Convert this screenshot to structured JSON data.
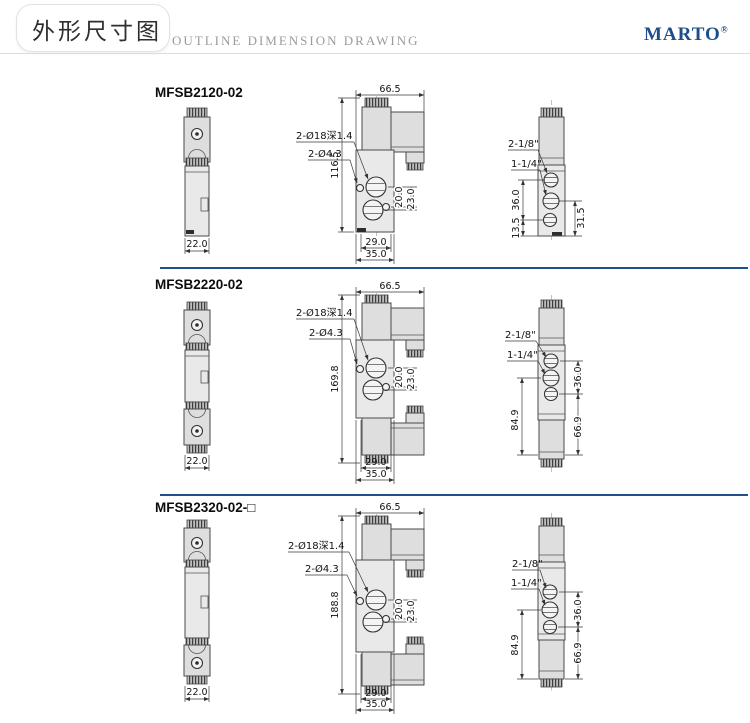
{
  "header": {
    "title_cn": "外形尺寸图",
    "title_en": "OUTLINE DIMENSION DRAWING",
    "brand": "MARTO",
    "brand_mark": "®"
  },
  "sections": [
    {
      "model": "MFSB2120-02",
      "front": {
        "width": "22.0"
      },
      "main": {
        "width": "66.5",
        "height": "116.5",
        "hole_label_1": "2-Ø18深1.4",
        "hole_label_2": "2-Ø4.3",
        "port_dim_1": "20.0",
        "port_dim_2": "23.0",
        "bottom_dim_1": "29.0",
        "bottom_dim_2": "35.0"
      },
      "side": {
        "thread_label_1": "2-1/8\"",
        "thread_label_2": "1-1/4\"",
        "dim_1": "36.0",
        "dim_2": "13.5",
        "dim_3": "31.5"
      }
    },
    {
      "model": "MFSB2220-02",
      "front": {
        "width": "22.0"
      },
      "main": {
        "width": "66.5",
        "height": "169.8",
        "hole_label_1": "2-Ø18深1.4",
        "hole_label_2": "2-Ø4.3",
        "port_dim_1": "20.0",
        "port_dim_2": "23.0",
        "bottom_dim_1": "29.0",
        "bottom_dim_2": "35.0"
      },
      "side": {
        "thread_label_1": "2-1/8\"",
        "thread_label_2": "1-1/4\"",
        "dim_1": "36.0",
        "dim_2": "84.9",
        "dim_3": "66.9"
      }
    },
    {
      "model": "MFSB2320-02-□",
      "front": {
        "width": "22.0"
      },
      "main": {
        "width": "66.5",
        "height": "188.8",
        "hole_label_1": "2-Ø18深1.4",
        "hole_label_2": "2-Ø4.3",
        "port_dim_1": "20.0",
        "port_dim_2": "23.0",
        "bottom_dim_1": "29.0",
        "bottom_dim_2": "35.0"
      },
      "side": {
        "thread_label_1": "2-1/8\"",
        "thread_label_2": "1-1/4\"",
        "dim_1": "36.0",
        "dim_2": "84.9",
        "dim_3": "66.9"
      }
    }
  ]
}
